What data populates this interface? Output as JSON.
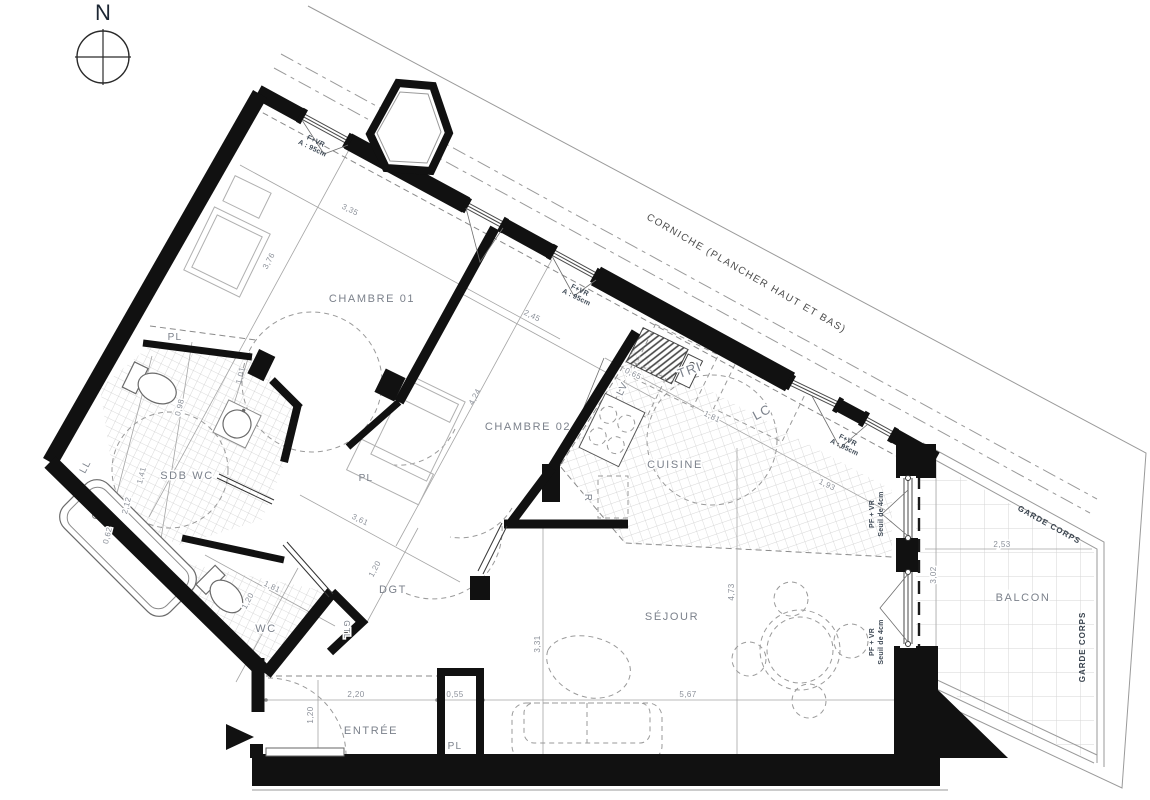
{
  "compass": {
    "north": "N"
  },
  "site": {
    "corniche": "CORNICHE (PLANCHER HAUT ET BAS)",
    "garde_corps": "GARDE CORPS"
  },
  "rooms": {
    "chambre01": "CHAMBRE 01",
    "chambre02": "CHAMBRE 02",
    "cuisine": "CUISINE",
    "sejour": "SÉJOUR",
    "sdb_wc": "SDB WC",
    "wc": "WC",
    "entree": "ENTRÉE",
    "dgt": "DGT",
    "balcon": "BALCON",
    "pl": "PL",
    "ll": "LL",
    "lv": "LV",
    "tri": "TRI",
    "lc": "LC",
    "r": "R",
    "gtl": "GTL"
  },
  "annotations": {
    "f_vr": "F+VR",
    "f_vr_h": "A : 95cm",
    "pf_vr": "PF + VR",
    "pf_vr_s": "Seuil de 4cm"
  },
  "dims": [
    "3,35",
    "3,76",
    "2,45",
    "4,24",
    "3,61",
    "0,65",
    "1,81",
    "1,93",
    "1,81",
    "1,20",
    "1,20",
    "0,98",
    "1,41",
    "2,12",
    "0,62",
    "1,01",
    "3,31",
    "4,73",
    "5,67",
    "2,20",
    "0,55",
    "1,20",
    "2,53",
    "3,02"
  ]
}
